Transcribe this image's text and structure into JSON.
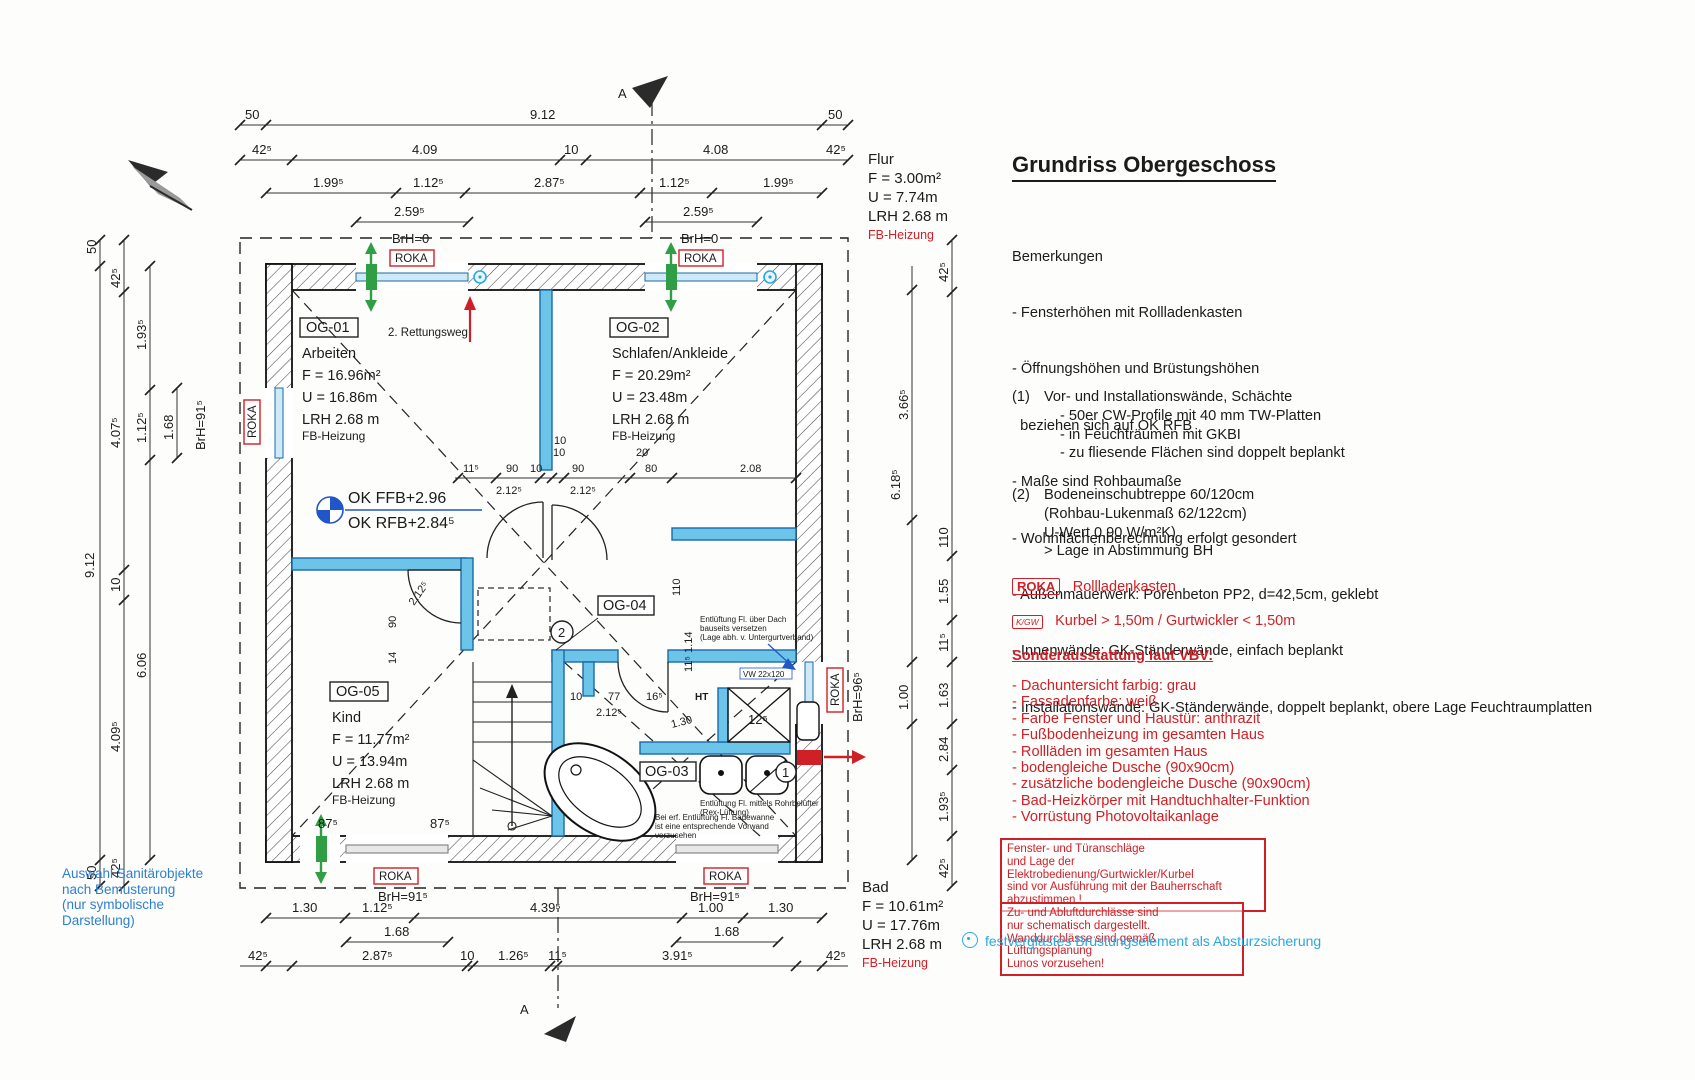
{
  "title": "Grundriss Obergeschoss",
  "remarks": {
    "heading": "Bemerkungen",
    "items": [
      "- Fensterhöhen mit Rollladenkasten",
      "- Öffnungshöhen und Brüstungshöhen",
      "  beziehen sich auf OK RFB",
      "- Maße sind Rohbaumaße",
      "- Wohnflächenberechnung erfolgt gesondert",
      "- Außenmauerwerk: Porenbeton PP2, d=42,5cm, geklebt",
      "- Innenwände: GK-Ständerwände, einfach beplankt",
      "- Installationswände: GK-Ständerwände, doppelt beplankt, obere Lage Feuchtraumplatten"
    ]
  },
  "note1": {
    "num": "(1)",
    "head": "Vor- und Installationswände, Schächte",
    "items": [
      "- 50er CW-Profile mit 40 mm TW-Platten",
      "- in Feuchträumen mit GKBI",
      "- zu fliesende Flächen sind doppelt beplankt"
    ]
  },
  "note2": {
    "num": "(2)",
    "lines": [
      "Bodeneinschubtreppe 60/120cm",
      "(Rohbau-Lukenmaß 62/122cm)",
      "U-Wert 0,90 W/m²K)",
      "> Lage in Abstimmung BH"
    ]
  },
  "legend": {
    "roka_tag": "ROKA",
    "roka_text": "Rollladenkasten",
    "kgw_tag": "K/GW",
    "kgw_text": "Kurbel > 1,50m / Gurtwickler < 1,50m"
  },
  "sonder": {
    "heading": "Sonderausstattung laut VBV:",
    "items": [
      "- Dachuntersicht farbig: grau",
      "- Fassadenfarbe: weiß",
      "- Farbe Fenster und Haustür: anthrazit",
      "- Fußbodenheizung im gesamten Haus",
      "- Rollläden im gesamten Haus",
      "- bodengleiche Dusche (90x90cm)",
      "- zusätzliche bodengleiche Dusche (90x90cm)",
      "- Bad-Heizkörper mit Handtuchhalter-Funktion",
      "- Vorrüstung Photovoltaikanlage"
    ]
  },
  "warnbox1": {
    "lines": [
      "Fenster- und Türanschläge",
      "und Lage der Elektrobedienung/Gurtwickler/Kurbel",
      "sind vor Ausführung mit der Bauherrschaft",
      "abzustimmen !"
    ]
  },
  "warnbox2": {
    "lines": [
      "Zu- und Abluftdurchlässe sind",
      "nur schematisch dargestellt.",
      "Wanddurchlässe sind gemäß Lüftungsplanung",
      "Lunos vorzusehen!"
    ]
  },
  "glazing_note": "festverglastes Brüstungselement als Absturzsicherung",
  "sanitary_note": {
    "lines": [
      "Auswahl Sanitärobjekte",
      "nach Bemusterung",
      "(nur symbolische",
      "Darstellung)"
    ]
  },
  "rooms": {
    "og01": {
      "id": "OG-01",
      "name": "Arbeiten",
      "f": "F = 16.96m²",
      "u": "U = 16.86m",
      "lrh": "LRH 2.68 m",
      "heat": "FB-Heizung"
    },
    "og02": {
      "id": "OG-02",
      "name": "Schlafen/Ankleide",
      "f": "F = 20.29m²",
      "u": "U = 23.48m",
      "lrh": "LRH 2.68 m",
      "heat": "FB-Heizung"
    },
    "og03": {
      "id": "OG-03"
    },
    "og04": {
      "id": "OG-04"
    },
    "og05": {
      "id": "OG-05",
      "name": "Kind",
      "f": "F = 11.77m²",
      "u": "U = 13.94m",
      "lrh": "LRH 2.68 m",
      "heat": "FB-Heizung"
    },
    "flur": {
      "name": "Flur",
      "f": "F = 3.00m²",
      "u": "U = 7.74m",
      "lrh": "LRH 2.68 m",
      "heat": "FB-Heizung"
    },
    "bad": {
      "name": "Bad",
      "f": "F = 10.61m²",
      "u": "U = 17.76m",
      "lrh": "LRH 2.68 m",
      "heat": "FB-Heizung"
    }
  },
  "labels": {
    "roka": "ROKA",
    "rettungsweg": "2. Rettungsweg",
    "ok_ffb": "OK FFB+2.96",
    "ok_rfb": "OK RFB+2.84⁵",
    "ht": "HT",
    "vw": "VW 22x120",
    "circ1": "1",
    "circ2": "2",
    "section": "A",
    "vent_roof": [
      "Entlüftung Fl. über Dach",
      "bauseits versetzen",
      "(Lage abh. v. Untergurtverband)"
    ],
    "vent_sink": [
      "Entlüftung Fl. mittels Rohrbelüfter",
      "(Rex-Lüftung)"
    ],
    "vent_tub": [
      "Bei erf. Entlüftung Fl. Badewanne",
      "ist eine entsprechende Vorwand",
      "vorzusehen"
    ]
  },
  "windows": {
    "brh0": "BrH=0",
    "brh91": "BrH=91⁵",
    "brh96": "BrH=96⁵"
  },
  "dims": {
    "top1": [
      "50",
      "9.12",
      "50"
    ],
    "top2": [
      "42⁵",
      "4.09",
      "10",
      "4.08",
      "42⁵"
    ],
    "top3": [
      "1.99⁵",
      "1.12⁵",
      "2.87⁵",
      "1.12⁵",
      "1.99⁵"
    ],
    "top4": [
      "2.59⁵",
      "2.59⁵"
    ],
    "left1": [
      "50",
      "9.12",
      "50"
    ],
    "left2": [
      "42⁵",
      "4.07⁵",
      "10",
      "4.09⁵",
      "42⁵"
    ],
    "left3": [
      "1.93⁵",
      "1.12⁵",
      "6.06"
    ],
    "left4": [
      "1.68"
    ],
    "right_inner": [
      "3.66⁵",
      "6.18⁵",
      "1.00"
    ],
    "right_outer": [
      "42⁵",
      "110",
      "1.55",
      "11⁵",
      "1.63",
      "2.84",
      "1.93⁵",
      "42⁵"
    ],
    "bottom1": [
      "1.30",
      "1.12⁵",
      "4.39⁵",
      "1.00",
      "1.30"
    ],
    "bottom2": [
      "1.68",
      "1.68"
    ],
    "bottom3": [
      "42⁵",
      "2.87⁵",
      "10",
      "1.26⁵",
      "11⁵",
      "3.91⁵",
      "42⁵"
    ],
    "mid_top": [
      "10",
      "20"
    ],
    "mid": [
      "11⁵",
      "90",
      "10",
      "10",
      "90",
      "80",
      "2.08"
    ],
    "mid_below": [
      "2.12⁵",
      "2.12⁵"
    ],
    "kind": [
      "90",
      "2.12⁵",
      "14",
      "87⁵",
      "87⁵"
    ],
    "bath_top": [
      "10",
      "77",
      "16⁵",
      "2.12⁵"
    ],
    "flur_v": [
      "110",
      "11⁵ 1.14"
    ],
    "shower": [
      "1.30",
      "12⁵"
    ]
  },
  "colors": {
    "red": "#cf2027",
    "wall_blue": "#6cc5e9",
    "wall_blue_edge": "#1a6aa5",
    "cyan": "#29a8e0",
    "blue_text": "#2056c8",
    "green": "#2f9e44"
  }
}
